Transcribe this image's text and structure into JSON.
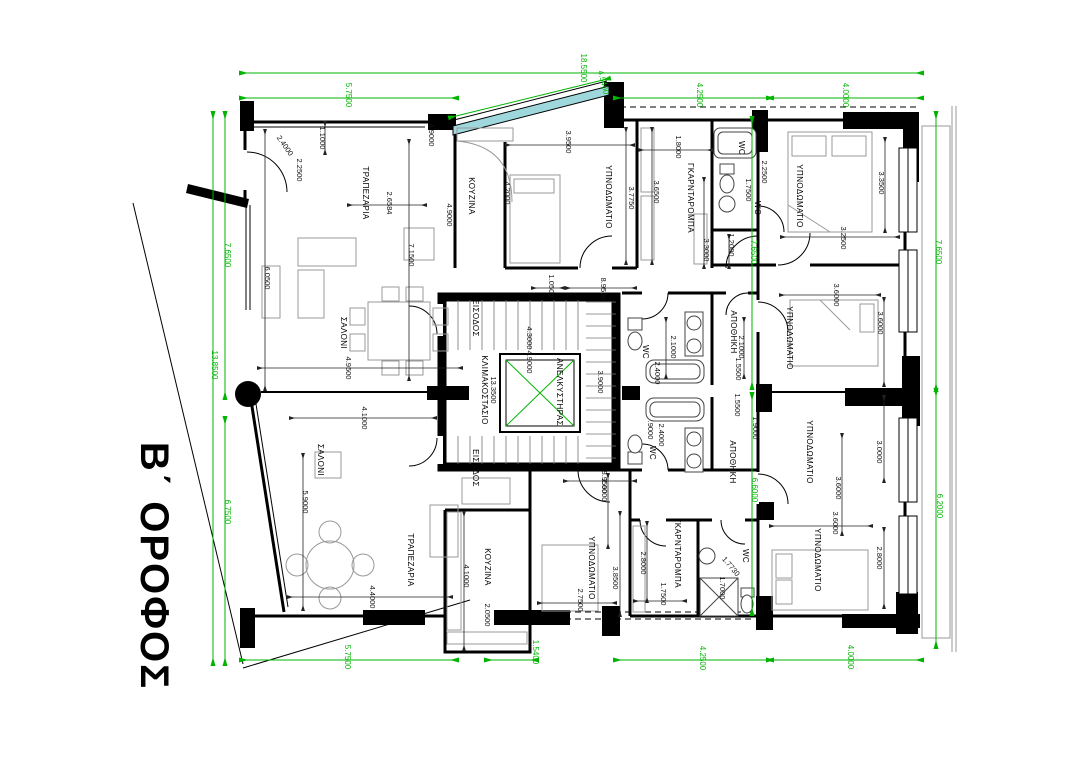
{
  "title": {
    "text": "Β΄ ΟΡΟΦΟΣ"
  },
  "colors": {
    "dimension_green": "#00b400",
    "wall_black": "#000000",
    "glazing_teal": "#9fd8dc"
  },
  "room_labels": [
    {
      "t": "ΤΡΑΠΕΖΑΡΙΑ",
      "x": 363,
      "y": 193
    },
    {
      "t": "ΚΟΥΖΙΝΑ",
      "x": 469,
      "y": 196
    },
    {
      "t": "ΣΑΛΟΝΙ",
      "x": 341,
      "y": 333
    },
    {
      "t": "ΣΑΛΟΝΙ",
      "x": 318,
      "y": 460
    },
    {
      "t": "ΤΡΑΠΕΖΑΡΙΑ",
      "x": 408,
      "y": 560
    },
    {
      "t": "ΚΟΥΖΙΝΑ",
      "x": 485,
      "y": 567
    },
    {
      "t": "ΥΠΝΟΔΩΜΑΤΙΟ",
      "x": 606,
      "y": 197
    },
    {
      "t": "ΓΚΑΡΝΤΑΡΟΜΠΑ",
      "x": 688,
      "y": 198
    },
    {
      "t": "ΥΠΝΟΔΩΜΑΤΙΟ",
      "x": 797,
      "y": 196
    },
    {
      "t": "ΥΠΝΟΔΩΜΑΤΙΟ",
      "x": 787,
      "y": 338
    },
    {
      "t": "ΥΠΝΟΔΩΜΑΤΙΟ",
      "x": 807,
      "y": 452
    },
    {
      "t": "ΥΠΝΟΔΩΜΑΤΙΟ",
      "x": 589,
      "y": 568
    },
    {
      "t": "ΓΚΑΡΝΤΑΡΟΜΠΑ",
      "x": 675,
      "y": 553
    },
    {
      "t": "ΥΠΝΟΔΩΜΑΤΙΟ",
      "x": 815,
      "y": 560
    },
    {
      "t": "ΑΠΟΘΗΚΗ",
      "x": 731,
      "y": 332
    },
    {
      "t": "ΑΠΟΘΗΚΗ",
      "x": 730,
      "y": 462
    },
    {
      "t": "ΚΛΙΜΑΚΟΣΤΑΣΙΟ",
      "x": 482,
      "y": 390
    },
    {
      "t": "ΑΝΕΛΚΥΣΤΗΡΑΣ",
      "x": 557,
      "y": 392
    },
    {
      "t": "ΕΙΣΟΔΟΣ",
      "x": 473,
      "y": 318
    },
    {
      "t": "ΕΙΣΟΔΟΣ",
      "x": 473,
      "y": 468
    },
    {
      "t": "WC",
      "x": 739,
      "y": 148
    },
    {
      "t": "WC",
      "x": 755,
      "y": 208
    },
    {
      "t": "WC",
      "x": 643,
      "y": 352
    },
    {
      "t": "WC",
      "x": 650,
      "y": 453
    },
    {
      "t": "WC",
      "x": 743,
      "y": 556
    }
  ],
  "black_dimensions": [
    {
      "t": "1.1000",
      "x": 320,
      "y": 138
    },
    {
      "t": "2.4000",
      "x": 283,
      "y": 147,
      "r": 55
    },
    {
      "t": "2.2500",
      "x": 297,
      "y": 170
    },
    {
      "t": "2.6584",
      "x": 387,
      "y": 203
    },
    {
      "t": "7.1500",
      "x": 409,
      "y": 255
    },
    {
      "t": "4.9000",
      "x": 429,
      "y": 135
    },
    {
      "t": "4.9000",
      "x": 447,
      "y": 215
    },
    {
      "t": "4.2000",
      "x": 505,
      "y": 193
    },
    {
      "t": "6.0500",
      "x": 265,
      "y": 278
    },
    {
      "t": "4.9500",
      "x": 346,
      "y": 368
    },
    {
      "t": "4.1000",
      "x": 362,
      "y": 418
    },
    {
      "t": "5.9000",
      "x": 303,
      "y": 502
    },
    {
      "t": "4.4000",
      "x": 370,
      "y": 597
    },
    {
      "t": "4.1000",
      "x": 464,
      "y": 576
    },
    {
      "t": "2.0500",
      "x": 485,
      "y": 615
    },
    {
      "t": "3.9500",
      "x": 566,
      "y": 142
    },
    {
      "t": "3.7750",
      "x": 629,
      "y": 198
    },
    {
      "t": "3.6500",
      "x": 654,
      "y": 192
    },
    {
      "t": "1.8000",
      "x": 676,
      "y": 147
    },
    {
      "t": "1.7500",
      "x": 746,
      "y": 190
    },
    {
      "t": "2.2500",
      "x": 762,
      "y": 172
    },
    {
      "t": "3.3000",
      "x": 704,
      "y": 250
    },
    {
      "t": "1.2000",
      "x": 729,
      "y": 245
    },
    {
      "t": "3.3500",
      "x": 879,
      "y": 183
    },
    {
      "t": "3.2500",
      "x": 841,
      "y": 238
    },
    {
      "t": "1.0500",
      "x": 549,
      "y": 286
    },
    {
      "t": "8.9500",
      "x": 601,
      "y": 289
    },
    {
      "t": "13.3500",
      "x": 491,
      "y": 390
    },
    {
      "t": "4.3000",
      "x": 527,
      "y": 338
    },
    {
      "t": "4.9000",
      "x": 527,
      "y": 362
    },
    {
      "t": "3.9000",
      "x": 598,
      "y": 382
    },
    {
      "t": "8.9500",
      "x": 602,
      "y": 482
    },
    {
      "t": "2.1000",
      "x": 671,
      "y": 347
    },
    {
      "t": "2.4000",
      "x": 655,
      "y": 373
    },
    {
      "t": "2.1000",
      "x": 739,
      "y": 347
    },
    {
      "t": "1.5500",
      "x": 736,
      "y": 369
    },
    {
      "t": "1.5500",
      "x": 735,
      "y": 405
    },
    {
      "t": "1.9000",
      "x": 753,
      "y": 428
    },
    {
      "t": "2.4000",
      "x": 659,
      "y": 435
    },
    {
      "t": ".9000",
      "x": 648,
      "y": 430
    },
    {
      "t": "3.6000",
      "x": 834,
      "y": 295
    },
    {
      "t": "3.6000",
      "x": 878,
      "y": 323
    },
    {
      "t": "3.0000",
      "x": 877,
      "y": 452
    },
    {
      "t": "3.6000",
      "x": 836,
      "y": 488
    },
    {
      "t": "2.6000",
      "x": 602,
      "y": 490
    },
    {
      "t": "2.7500",
      "x": 578,
      "y": 600
    },
    {
      "t": "3.8500",
      "x": 613,
      "y": 578
    },
    {
      "t": "2.8000",
      "x": 641,
      "y": 563
    },
    {
      "t": "1.7500",
      "x": 661,
      "y": 594
    },
    {
      "t": "1.7730",
      "x": 729,
      "y": 568,
      "r": 50
    },
    {
      "t": "1.7000",
      "x": 720,
      "y": 588
    },
    {
      "t": "3.6000",
      "x": 833,
      "y": 523
    },
    {
      "t": "2.8000",
      "x": 877,
      "y": 558
    }
  ],
  "green_dimensions": [
    {
      "t": "18.5500",
      "x": 581,
      "y": 68
    },
    {
      "t": "5.7500",
      "x": 346,
      "y": 95
    },
    {
      "t": "4.5400",
      "x": 601,
      "y": 83,
      "r": 76
    },
    {
      "t": "4.2500",
      "x": 697,
      "y": 95
    },
    {
      "t": "4.0000",
      "x": 843,
      "y": 95
    },
    {
      "t": "7.6500",
      "x": 225,
      "y": 255
    },
    {
      "t": "13.8500",
      "x": 212,
      "y": 365
    },
    {
      "t": "6.7500",
      "x": 225,
      "y": 512
    },
    {
      "t": "7.6500",
      "x": 936,
      "y": 252
    },
    {
      "t": "6.2000",
      "x": 937,
      "y": 506
    },
    {
      "t": "7.6500",
      "x": 751,
      "y": 252
    },
    {
      "t": "6.6000",
      "x": 752,
      "y": 490
    },
    {
      "t": "5.7500",
      "x": 345,
      "y": 657
    },
    {
      "t": "1.5400",
      "x": 533,
      "y": 652
    },
    {
      "t": "4.2500",
      "x": 700,
      "y": 658
    },
    {
      "t": "4.0000",
      "x": 848,
      "y": 657
    }
  ]
}
